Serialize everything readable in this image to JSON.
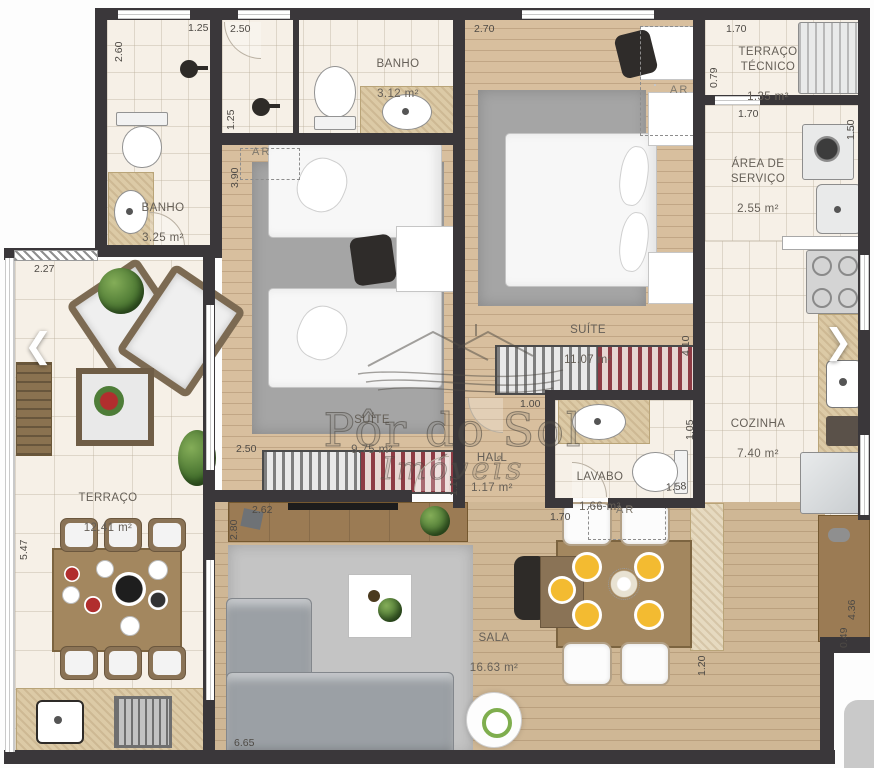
{
  "watermark": {
    "line1": "Pôr do Sol",
    "line2": "Imóveis"
  },
  "nav": {
    "prev": "❮",
    "next": "❯"
  },
  "ac_label": "AR",
  "rooms": {
    "banho1": {
      "name": "BANHO",
      "area": "3.25 m²"
    },
    "banho2": {
      "name": "BANHO",
      "area": "3.12 m²"
    },
    "terraco_tecnico": {
      "name": "TERRAÇO\nTÉCNICO",
      "area": "1.35 m²"
    },
    "area_servico": {
      "name": "ÁREA DE\nSERVIÇO",
      "area": "2.55 m²"
    },
    "suite_grande": {
      "name": "SUÍTE",
      "area": "11.07 m²"
    },
    "suite_pequena": {
      "name": "SUÍTE",
      "area": "9.75 m²"
    },
    "hall": {
      "name": "HALL",
      "area": "1.17 m²"
    },
    "lavabo": {
      "name": "LAVABO",
      "area": "1.66 m²"
    },
    "cozinha": {
      "name": "COZINHA",
      "area": "7.40 m²"
    },
    "terraco": {
      "name": "TERRAÇO",
      "area": "12.41 m²"
    },
    "sala": {
      "name": "SALA",
      "area": "16.63 m²"
    }
  },
  "dims": {
    "d260": "2.60",
    "d125a": "1.25",
    "d250a": "2.50",
    "d125b": "1.25",
    "d270": "2.70",
    "d170a": "1.70",
    "d079": "0.79",
    "d170b": "1.70",
    "d150": "1.50",
    "d390": "3.90",
    "d410": "4.10",
    "d100": "1.00",
    "d105": "1.05",
    "d117": "1.17",
    "d158": "1.58",
    "d170c": "1.70",
    "d250b": "2.50",
    "d227": "2.27",
    "d547": "5.47",
    "d280": "2.80",
    "d262": "2.62",
    "d665": "6.65",
    "d120": "1.20",
    "d436": "4.36",
    "d049": "0.49"
  },
  "colors": {
    "wall": "#3a373a",
    "wood": "#d8bf9e",
    "tile": "#f6f0e7",
    "granite": "#dccaa6",
    "accent_green": "#4e7d38",
    "plate_yellow": "#f3bb31"
  }
}
